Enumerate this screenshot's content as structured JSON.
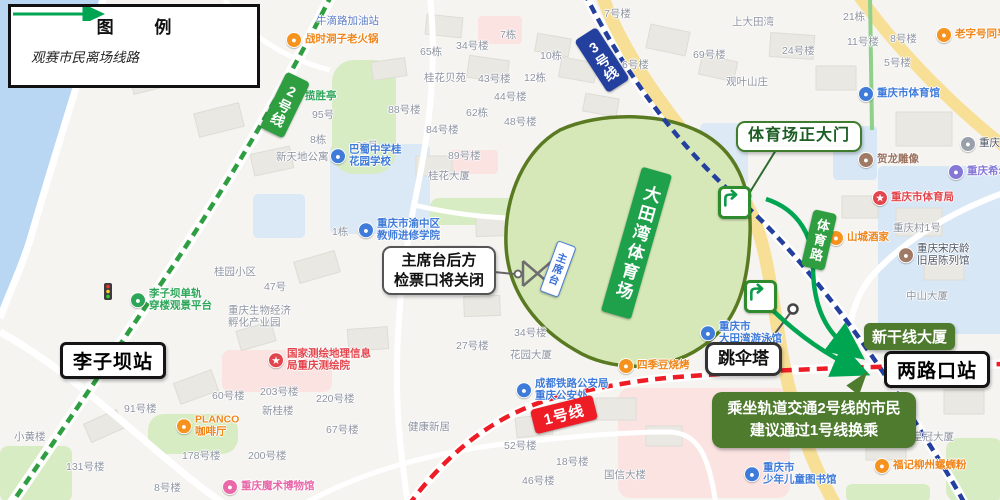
{
  "legend": {
    "title": "图  例",
    "route_label": "观赛市民离场线路"
  },
  "lines": {
    "line1": "1号线",
    "line2": "2号线",
    "line3": "3号线"
  },
  "stations": {
    "liziba": "李子坝站",
    "lianglukou": "两路口站"
  },
  "callouts": {
    "main_gate": "体育场正大门",
    "closed_l1": "主席台后方",
    "closed_l2": "检票口将关闭",
    "tower": "跳伞塔",
    "shinkansen": "新干线大厦",
    "advice_l1": "乘坐轨道交通2号线的市民",
    "advice_l2": "建议通过1号线换乘"
  },
  "area": {
    "stadium": "大田湾体育场",
    "rostrum": "主席台",
    "tiyu_road": "体育路"
  },
  "colors": {
    "line1": "#ee1c25",
    "line2": "#2f9e41",
    "line3": "#24409e",
    "route": "#00a551",
    "stadium_fill": "#d6e8b8",
    "stadium_border": "#5a7a22",
    "stadium_banner": "#1fa14c",
    "advice_green": "#4e7b2e",
    "water": "#b9d7f2",
    "road_yellow": "#f7df96"
  },
  "pois": [
    {
      "t": [
        "牛滴路加油站"
      ],
      "x": 316,
      "y": 22,
      "c": "bluegray"
    },
    {
      "t": [
        "战时洞子老火锅"
      ],
      "x": 286,
      "y": 40,
      "c": "orange",
      "i": "orange"
    },
    {
      "t": [
        "揽胜亭"
      ],
      "x": 286,
      "y": 97,
      "c": "green",
      "i": "green"
    },
    {
      "t": [
        "7号楼"
      ],
      "x": 604,
      "y": 15,
      "c": "gray"
    },
    {
      "t": [
        "上大田湾"
      ],
      "x": 732,
      "y": 23,
      "c": "gray"
    },
    {
      "t": [
        "21栋"
      ],
      "x": 843,
      "y": 18,
      "c": "gray"
    },
    {
      "t": [
        "69号楼"
      ],
      "x": 693,
      "y": 56,
      "c": "gray"
    },
    {
      "t": [
        "观叶山庄"
      ],
      "x": 726,
      "y": 83,
      "c": "gray"
    },
    {
      "t": [
        "10栋"
      ],
      "x": 540,
      "y": 57,
      "c": "gray"
    },
    {
      "t": [
        "6号楼"
      ],
      "x": 622,
      "y": 66,
      "c": "gray"
    },
    {
      "t": [
        "11号楼"
      ],
      "x": 847,
      "y": 43,
      "c": "gray"
    },
    {
      "t": [
        "8号楼"
      ],
      "x": 890,
      "y": 40,
      "c": "gray"
    },
    {
      "t": [
        "24号楼"
      ],
      "x": 782,
      "y": 52,
      "c": "gray"
    },
    {
      "t": [
        "5号楼"
      ],
      "x": 884,
      "y": 64,
      "c": "gray"
    },
    {
      "t": [
        "老字号同孚"
      ],
      "x": 936,
      "y": 35,
      "c": "orange",
      "i": "orange"
    },
    {
      "t": [
        "重庆市体育馆"
      ],
      "x": 858,
      "y": 94,
      "c": "blue",
      "i": "blue"
    },
    {
      "t": [
        "贺龙雕像"
      ],
      "x": 858,
      "y": 160,
      "c": "brown",
      "i": "brown"
    },
    {
      "t": [
        "重庆市体育局"
      ],
      "x": 872,
      "y": 198,
      "c": "red",
      "i": "red",
      "g": "★"
    },
    {
      "t": [
        "山城酒家"
      ],
      "x": 828,
      "y": 238,
      "c": "orange",
      "i": "orange"
    },
    {
      "t": [
        "重庆村1号"
      ],
      "x": 893,
      "y": 229,
      "c": "gray"
    },
    {
      "t": [
        "重庆宋庆龄",
        "旧居陈列馆"
      ],
      "x": 898,
      "y": 255,
      "c": "dark",
      "i": "brown"
    },
    {
      "t": [
        "中山大厦"
      ],
      "x": 906,
      "y": 297,
      "c": "gray"
    },
    {
      "t": [
        "重庆希尔顿"
      ],
      "x": 948,
      "y": 172,
      "c": "purple",
      "i": "purple"
    },
    {
      "t": [
        "重庆"
      ],
      "x": 960,
      "y": 144,
      "c": "dark",
      "i": "gray"
    },
    {
      "t": [
        "桂花大厦"
      ],
      "x": 428,
      "y": 177,
      "c": "gray"
    },
    {
      "t": [
        "89号楼"
      ],
      "x": 448,
      "y": 157,
      "c": "gray"
    },
    {
      "t": [
        "98号"
      ],
      "x": 356,
      "y": 147,
      "c": "gray"
    },
    {
      "t": [
        "95号"
      ],
      "x": 312,
      "y": 116,
      "c": "gray"
    },
    {
      "t": [
        "88号楼"
      ],
      "x": 388,
      "y": 111,
      "c": "gray"
    },
    {
      "t": [
        "8栋"
      ],
      "x": 310,
      "y": 141,
      "c": "gray"
    },
    {
      "t": [
        "新天地公寓"
      ],
      "x": 276,
      "y": 158,
      "c": "gray"
    },
    {
      "t": [
        "65栋"
      ],
      "x": 420,
      "y": 53,
      "c": "gray"
    },
    {
      "t": [
        "34号楼"
      ],
      "x": 456,
      "y": 47,
      "c": "gray"
    },
    {
      "t": [
        "7栋"
      ],
      "x": 500,
      "y": 36,
      "c": "gray"
    },
    {
      "t": [
        "43号楼"
      ],
      "x": 478,
      "y": 80,
      "c": "gray"
    },
    {
      "t": [
        "12栋"
      ],
      "x": 524,
      "y": 79,
      "c": "gray"
    },
    {
      "t": [
        "44号楼"
      ],
      "x": 494,
      "y": 98,
      "c": "gray"
    },
    {
      "t": [
        "62栋"
      ],
      "x": 466,
      "y": 114,
      "c": "gray"
    },
    {
      "t": [
        "48号楼"
      ],
      "x": 504,
      "y": 123,
      "c": "gray"
    },
    {
      "t": [
        "84号楼"
      ],
      "x": 426,
      "y": 131,
      "c": "gray"
    },
    {
      "t": [
        "桂花贝苑"
      ],
      "x": 424,
      "y": 79,
      "c": "gray"
    },
    {
      "t": [
        "巴蜀中学桂",
        "花园学校"
      ],
      "x": 330,
      "y": 156,
      "c": "blue",
      "i": "blue"
    },
    {
      "t": [
        "重庆市渝中区",
        "教师进修学院"
      ],
      "x": 358,
      "y": 230,
      "c": "blue",
      "i": "blue"
    },
    {
      "t": [
        "1栋"
      ],
      "x": 332,
      "y": 233,
      "c": "gray"
    },
    {
      "t": [
        "桂园小区"
      ],
      "x": 214,
      "y": 273,
      "c": "gray"
    },
    {
      "t": [
        "47号"
      ],
      "x": 264,
      "y": 288,
      "c": "gray"
    },
    {
      "t": [
        "李子坝单轨",
        "穿楼观景平台"
      ],
      "x": 130,
      "y": 300,
      "c": "green",
      "i": "green"
    },
    {
      "t": [
        "重庆生物经济",
        "孵化产业园"
      ],
      "x": 228,
      "y": 317,
      "c": "gray"
    },
    {
      "t": [
        "58号楼"
      ],
      "x": 300,
      "y": 356,
      "c": "gray"
    },
    {
      "t": [
        "国家测绘地理信息",
        "局重庆测绘院"
      ],
      "x": 268,
      "y": 360,
      "c": "red",
      "i": "red",
      "g": "★"
    },
    {
      "t": [
        "203号楼"
      ],
      "x": 260,
      "y": 393,
      "c": "gray"
    },
    {
      "t": [
        "220号楼"
      ],
      "x": 316,
      "y": 400,
      "c": "gray"
    },
    {
      "t": [
        "60号楼"
      ],
      "x": 212,
      "y": 397,
      "c": "gray"
    },
    {
      "t": [
        "新桂楼"
      ],
      "x": 262,
      "y": 412,
      "c": "gray"
    },
    {
      "t": [
        "91号楼"
      ],
      "x": 124,
      "y": 410,
      "c": "gray"
    },
    {
      "t": [
        "PLANCO",
        "咖啡厅"
      ],
      "x": 176,
      "y": 426,
      "c": "orange",
      "i": "orange"
    },
    {
      "t": [
        "178号楼"
      ],
      "x": 182,
      "y": 457,
      "c": "gray"
    },
    {
      "t": [
        "200号楼"
      ],
      "x": 248,
      "y": 457,
      "c": "gray"
    },
    {
      "t": [
        "67号楼"
      ],
      "x": 326,
      "y": 431,
      "c": "gray"
    },
    {
      "t": [
        "8号楼"
      ],
      "x": 154,
      "y": 489,
      "c": "gray"
    },
    {
      "t": [
        "重庆魔术博物馆"
      ],
      "x": 222,
      "y": 487,
      "c": "pink",
      "i": "pink"
    },
    {
      "t": [
        "小黄楼"
      ],
      "x": 14,
      "y": 438,
      "c": "gray"
    },
    {
      "t": [
        "131号楼"
      ],
      "x": 66,
      "y": 468,
      "c": "gray"
    },
    {
      "t": [
        "27号楼"
      ],
      "x": 456,
      "y": 347,
      "c": "gray"
    },
    {
      "t": [
        "34号楼"
      ],
      "x": 514,
      "y": 334,
      "c": "gray"
    },
    {
      "t": [
        "花园大厦"
      ],
      "x": 510,
      "y": 356,
      "c": "gray"
    },
    {
      "t": [
        "成都铁路公安局",
        "重庆公安处"
      ],
      "x": 516,
      "y": 390,
      "c": "blue",
      "i": "blue"
    },
    {
      "t": [
        "健康新居"
      ],
      "x": 408,
      "y": 428,
      "c": "gray"
    },
    {
      "t": [
        "52号楼"
      ],
      "x": 504,
      "y": 447,
      "c": "gray"
    },
    {
      "t": [
        "18号楼"
      ],
      "x": 556,
      "y": 463,
      "c": "gray"
    },
    {
      "t": [
        "46号楼"
      ],
      "x": 522,
      "y": 482,
      "c": "gray"
    },
    {
      "t": [
        "国信大楼"
      ],
      "x": 604,
      "y": 476,
      "c": "gray"
    },
    {
      "t": [
        "四季豆烧烤"
      ],
      "x": 618,
      "y": 366,
      "c": "orange",
      "i": "orange"
    },
    {
      "t": [
        "重庆市",
        "大田湾游泳馆"
      ],
      "x": 700,
      "y": 333,
      "c": "blue",
      "i": "blue"
    },
    {
      "t": [
        "皇冠大厦"
      ],
      "x": 912,
      "y": 438,
      "c": "gray"
    },
    {
      "t": [
        "福记柳州螺蛳粉"
      ],
      "x": 874,
      "y": 466,
      "c": "orange",
      "i": "orange"
    },
    {
      "t": [
        "重庆市",
        "少年儿童图书馆"
      ],
      "x": 744,
      "y": 474,
      "c": "blue",
      "i": "blue"
    }
  ]
}
